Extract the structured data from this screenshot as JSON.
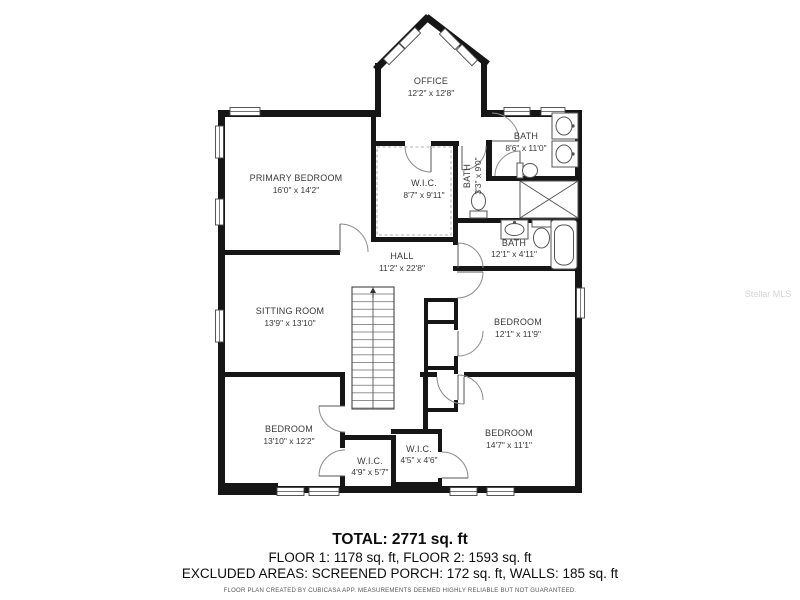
{
  "floorplan": {
    "rooms": [
      {
        "id": "office",
        "name": "OFFICE",
        "dims": "12'2\" x 12'8\""
      },
      {
        "id": "primary-bedroom",
        "name": "PRIMARY BEDROOM",
        "dims": "16'0\" x 14'2\""
      },
      {
        "id": "wic-primary",
        "name": "W.I.C.",
        "dims": "8'7\" x 9'11\""
      },
      {
        "id": "bath-small",
        "name": "BATH",
        "dims": "3'3\" x 9'0\""
      },
      {
        "id": "bath-top-right",
        "name": "BATH",
        "dims": "8'6\" x 11'0\""
      },
      {
        "id": "bath-middle",
        "name": "BATH",
        "dims": "12'1\" x 4'11\""
      },
      {
        "id": "hall",
        "name": "HALL",
        "dims": "11'2\" x 22'8\""
      },
      {
        "id": "sitting-room",
        "name": "SITTING ROOM",
        "dims": "13'9\" x 13'10\""
      },
      {
        "id": "bedroom-right",
        "name": "BEDROOM",
        "dims": "12'1\" x 11'9\""
      },
      {
        "id": "bedroom-bottom-left",
        "name": "BEDROOM",
        "dims": "13'10\" x 12'2\""
      },
      {
        "id": "bedroom-bottom-right",
        "name": "BEDROOM",
        "dims": "14'7\" x 11'1\""
      },
      {
        "id": "wic-bottom-left",
        "name": "W.I.C.",
        "dims": "4'9\" x 5'7\""
      },
      {
        "id": "wic-bottom-right",
        "name": "W.I.C.",
        "dims": "4'5\" x 4'6\""
      }
    ],
    "summary": {
      "total": "TOTAL: 2771 sq. ft",
      "floors": "FLOOR 1: 1178 sq. ft, FLOOR 2: 1593 sq. ft",
      "excluded": "EXCLUDED AREAS: SCREENED PORCH: 172 sq. ft, WALLS: 185 sq. ft",
      "disclaimer": "FLOOR PLAN CREATED BY CUBICASA APP. MEASUREMENTS DEEMED HIGHLY RELIABLE BUT NOT GUARANTEED."
    },
    "watermark": "Stellar MLS",
    "colors": {
      "wall": "#161616",
      "label": "#3a3a3a",
      "fixture": "#555555"
    }
  }
}
